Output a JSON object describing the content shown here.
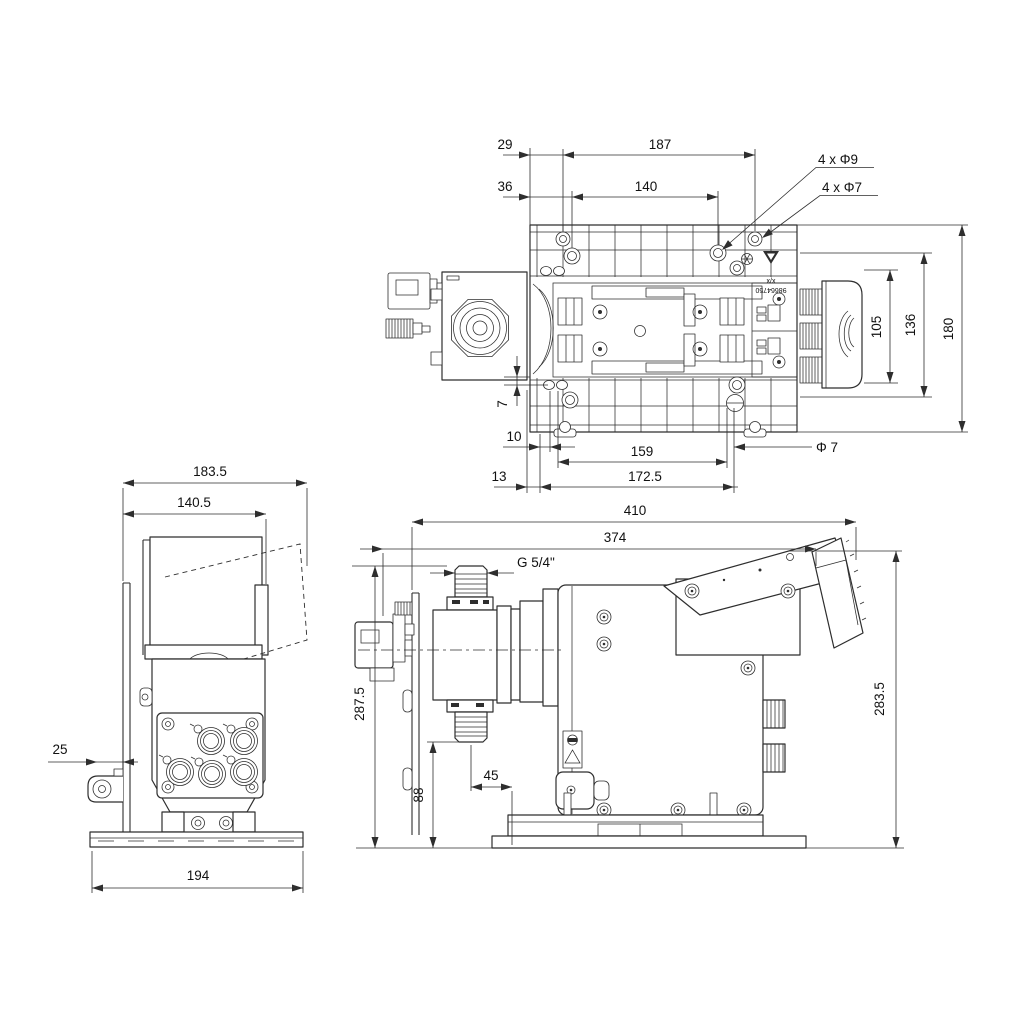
{
  "drawing": {
    "kind": "dimensional technical drawing, dosing pump, three orthographic views",
    "colors": {
      "line": "#2e2e2e",
      "background": "#ffffff"
    }
  },
  "dims": {
    "top": {
      "d29": "29",
      "d187": "187",
      "d36": "36",
      "d140": "140",
      "holes9": "4 x Φ9",
      "holes7": "4 x Φ7",
      "d105": "105",
      "d136": "136",
      "d180": "180",
      "d7": "7",
      "d10": "10",
      "d159": "159",
      "phi7": "Φ 7",
      "d13": "13",
      "d172_5": "172.5"
    },
    "front": {
      "d183_5": "183.5",
      "d140_5": "140.5",
      "d25": "25",
      "d194": "194"
    },
    "side": {
      "d410": "410",
      "d374": "374",
      "thread": "G 5/4\"",
      "d287_5": "287.5",
      "d283_5": "283.5",
      "d88": "88",
      "d45": "45"
    },
    "labels": {
      "xx": "x/x",
      "part_no": "98664750"
    }
  }
}
